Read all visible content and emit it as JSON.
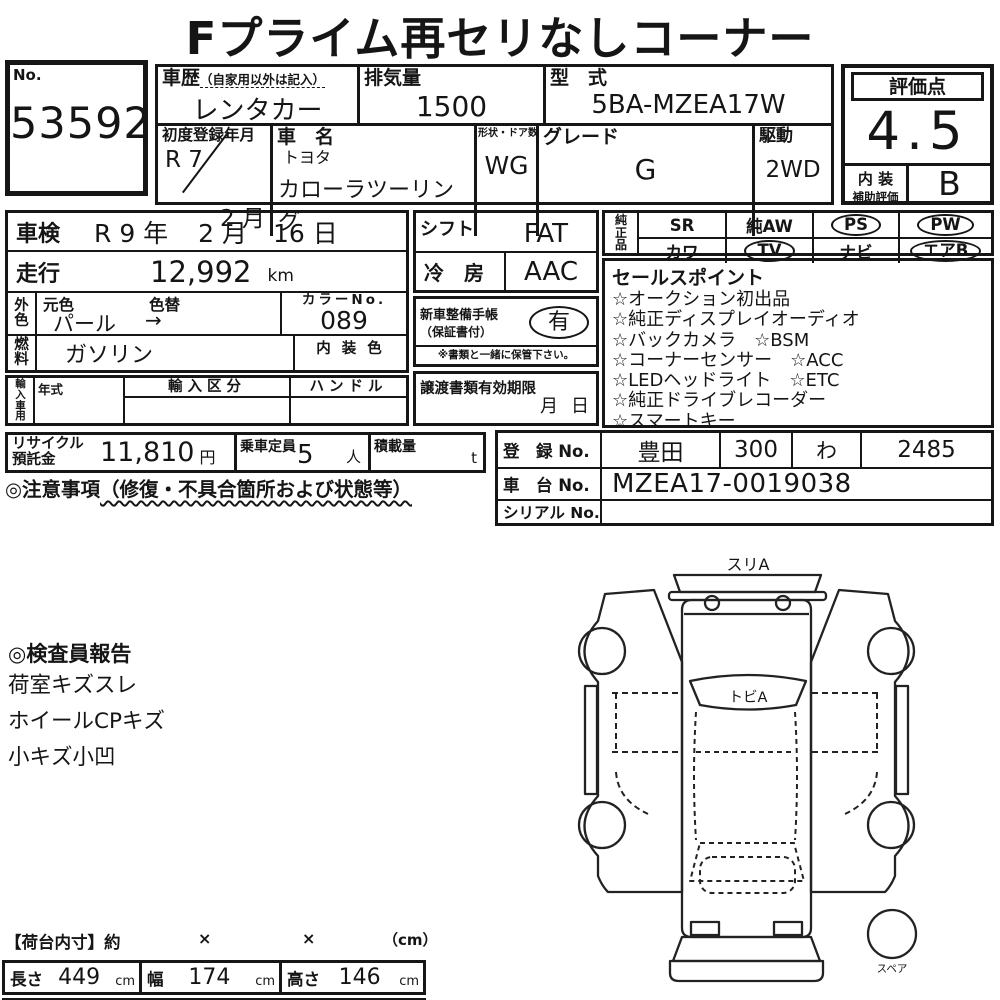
{
  "title": "Fプライム再セリなしコーナー",
  "lot": {
    "label": "No.",
    "number": "53592"
  },
  "head": {
    "history_label": "車歴",
    "history_note": "（自家用以外は記入）",
    "history": "レンタカー",
    "disp_label": "排気量",
    "disp": "1500",
    "model_label": "型　式",
    "model": "5BA-MZEA17W",
    "first_reg_label": "初度登録年月",
    "first_reg_top": "R 7",
    "first_reg_bottom": "2 月",
    "name_label": "車　名",
    "maker": "トヨタ",
    "car_name": "カローラツーリング",
    "body_label": "形状・ドア数",
    "body": "WG",
    "grade_label": "グレード",
    "grade": "G",
    "drive_label": "駆動",
    "drive": "2WD"
  },
  "rating": {
    "score_label": "評価点",
    "score": "4.5",
    "interior_label1": "内 装",
    "interior_label2": "補助評価",
    "interior_grade": "B"
  },
  "inspection": {
    "label": "車検",
    "year": "R 9 年",
    "month": "2 月",
    "day": "16 日"
  },
  "mileage": {
    "label": "走行",
    "value": "12,992",
    "unit": "km"
  },
  "color": {
    "label": "外色",
    "orig_label": "元色",
    "change_label": "色替",
    "value": "パール",
    "arrow": "→",
    "no_label": "カラーNo.",
    "no": "089"
  },
  "fuel": {
    "label": "燃料",
    "value": "ガソリン",
    "interior_color_label": "内 装 色"
  },
  "import": {
    "label": "輸入車用",
    "year_label": "年式",
    "class_label": "輸入区分",
    "handle_label": "ハンドル"
  },
  "shift": {
    "label": "シフト",
    "value": "FAT"
  },
  "ac": {
    "label": "冷　房",
    "value": "AAC"
  },
  "book": {
    "label1": "新車整備手帳",
    "label2": "（保証書付）",
    "value": "有",
    "note": "※書類と一緒に保管下さい。"
  },
  "transfer": {
    "label": "譲渡書類有効期限",
    "month": "月",
    "day": "日"
  },
  "genuine": {
    "label": "純正品",
    "sr": "SR",
    "aw": "純AW",
    "ps": "PS",
    "pw": "PW",
    "kawa": "カワ",
    "tv": "TV",
    "navi": "ナビ",
    "airb": "エアB"
  },
  "sales": {
    "title": "セールスポイント",
    "items": [
      "☆オークション初出品",
      "☆純正ディスプレイオーディオ",
      "☆バックカメラ　☆BSM",
      "☆コーナーセンサー　☆ACC",
      "☆LEDヘッドライト　☆ETC",
      "☆純正ドライブレコーダー",
      "☆スマートキー"
    ]
  },
  "recycle": {
    "label1": "リサイクル",
    "label2": "預託金",
    "amount": "11,810",
    "unit": "円"
  },
  "capacity": {
    "label": "乗車定員",
    "value": "5",
    "unit": "人"
  },
  "load": {
    "label": "積載量",
    "unit": "t"
  },
  "caution": {
    "title": "◎注意事項",
    "note": "（修復・不具合箇所および状態等）"
  },
  "registration": {
    "reg_label": "登　録 No.",
    "area": "豊田",
    "class_no": "300",
    "kana": "わ",
    "number": "2485",
    "chassis_label": "車　台 No.",
    "chassis": "MZEA17-0019038",
    "serial_label": "シリアル No."
  },
  "inspector": {
    "title": "◎検査員報告",
    "lines": [
      "荷室キズスレ",
      "ホイールCPキズ",
      "小キズ小凹"
    ]
  },
  "diagram": {
    "front_label": "スリA",
    "windshield_label": "トビA",
    "spare_label": "スペア"
  },
  "cargo": {
    "header": "【荷台内寸】約",
    "times1": "×",
    "times2": "×",
    "unit_header": "（cm）",
    "length_label": "長さ",
    "length": "449",
    "length_unit": "cm",
    "width_label": "幅",
    "width": "174",
    "width_unit": "cm",
    "height_label": "高さ",
    "height": "146",
    "height_unit": "cm"
  }
}
